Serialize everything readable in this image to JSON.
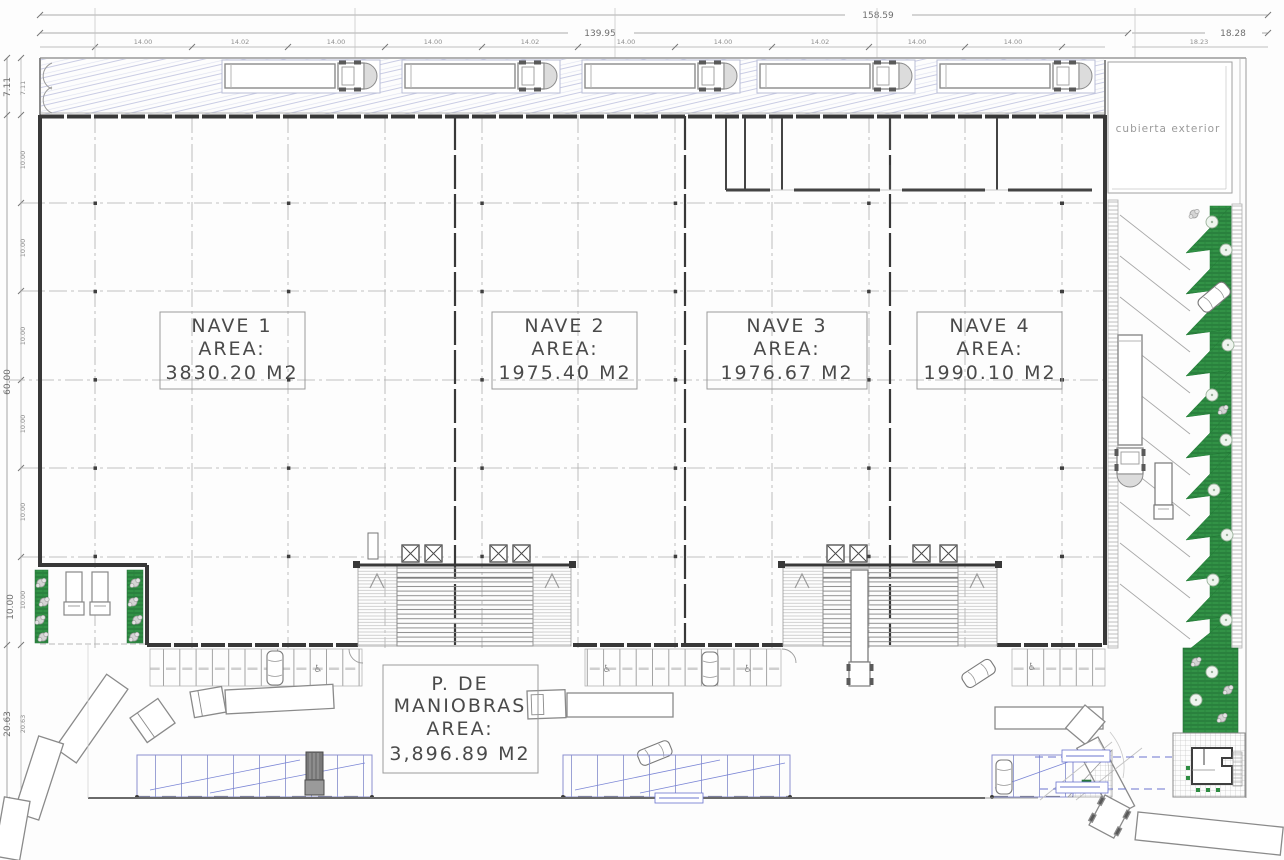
{
  "dims_top": {
    "overall": "158.59",
    "building": "139.95",
    "right": "18.28",
    "right_bay": "18.23",
    "bays": [
      "14.00",
      "14.02",
      "14.00",
      "14.00",
      "14.02",
      "14.00",
      "14.00",
      "14.02",
      "14.00",
      "14.00"
    ]
  },
  "dims_left": {
    "canopy": "7.11",
    "canopy_inner": "7.11",
    "overall": "60.00",
    "dock": "10.00",
    "yard": "20.63",
    "yard_inner": "20.63",
    "bays": [
      "10.00",
      "10.00",
      "10.00",
      "10.00",
      "10.00",
      "10.00"
    ]
  },
  "naves": [
    {
      "name": "NAVE 1",
      "area_label": "AREA:",
      "area": "3830.20 M2"
    },
    {
      "name": "NAVE 2",
      "area_label": "AREA:",
      "area": "1975.40 M2"
    },
    {
      "name": "NAVE 3",
      "area_label": "AREA:",
      "area": "1976.67 M2"
    },
    {
      "name": "NAVE 4",
      "area_label": "AREA:",
      "area": "1990.10 M2"
    }
  ],
  "maneuver_area": {
    "line1": "P. DE",
    "line2": "MANIOBRAS",
    "line3": "AREA:",
    "line4": "3,896.89 M2"
  },
  "labels": {
    "canopy_exterior": "cubierta exterior"
  },
  "icons": {
    "accessible": "♿"
  },
  "colors": {
    "wall_dark": "#3a3a3a",
    "line_mid": "#8a8a8a",
    "line_light": "#b9b9b9",
    "hatch_blue": "#c9cce4",
    "accent_blue": "#6a74cf",
    "green_dark": "#257038",
    "green_mid": "#2e8c42",
    "dim_text": "#6e6e6e",
    "label_text": "#4a4a4a"
  }
}
